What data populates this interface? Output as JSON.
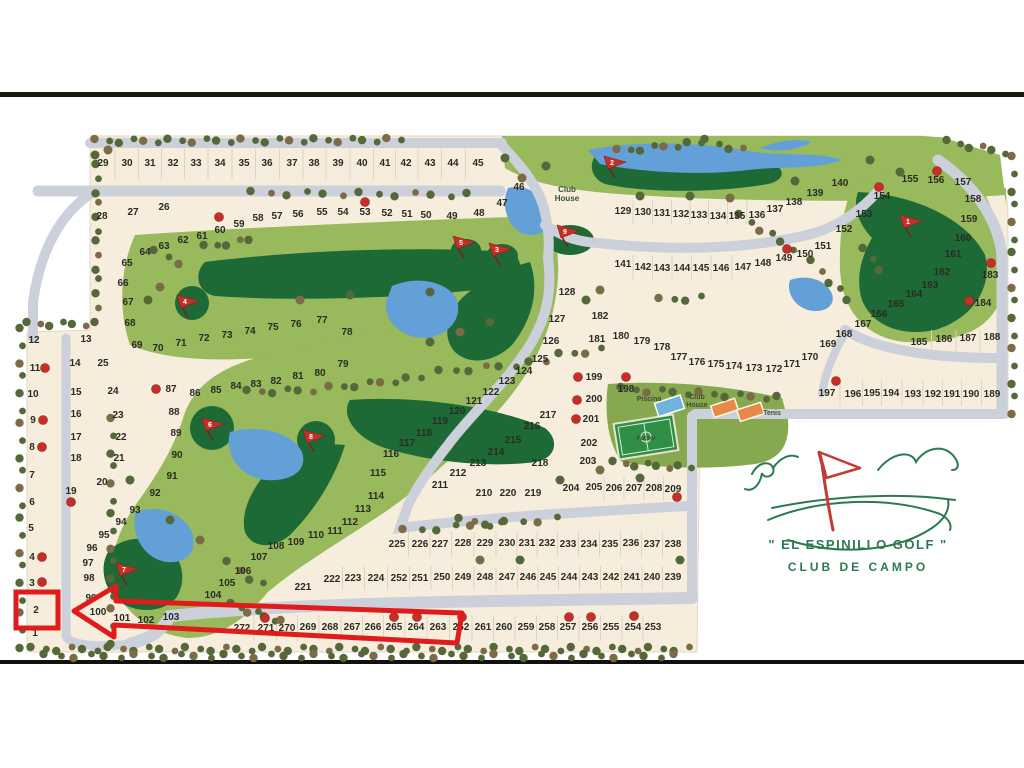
{
  "map": {
    "title": "El Espinillo Golf - Club de Campo - master plan",
    "logo": {
      "line1": "\" EL ESPINILLO GOLF \"",
      "line2": "CLUB DE CAMPO"
    },
    "labels": [
      {
        "id": "club-house-top",
        "lines": [
          "Club",
          "House"
        ],
        "x": 567,
        "y": 192,
        "size": 8
      },
      {
        "id": "piscina",
        "lines": [
          "Piscina"
        ],
        "x": 649,
        "y": 401,
        "size": 7
      },
      {
        "id": "club-house-amenity",
        "lines": [
          "Club",
          "House"
        ],
        "x": 697,
        "y": 399,
        "size": 7
      },
      {
        "id": "tenis",
        "lines": [
          "Tenis"
        ],
        "x": 772,
        "y": 415,
        "size": 7
      },
      {
        "id": "futbol",
        "lines": [
          "Futbol"
        ],
        "x": 646,
        "y": 440,
        "size": 6
      }
    ],
    "hole_flags": [
      [
        1,
        911,
        222
      ],
      [
        2,
        615,
        163
      ],
      [
        3,
        500,
        250
      ],
      [
        4,
        188,
        302
      ],
      [
        5,
        464,
        243
      ],
      [
        6,
        213,
        425
      ],
      [
        7,
        127,
        570
      ],
      [
        8,
        314,
        437
      ],
      [
        9,
        568,
        232
      ]
    ],
    "red_dots": [
      [
        219,
        217
      ],
      [
        365,
        202
      ],
      [
        156,
        389
      ],
      [
        71,
        502
      ],
      [
        45,
        368
      ],
      [
        43,
        420
      ],
      [
        42,
        447
      ],
      [
        42,
        557
      ],
      [
        42,
        582
      ],
      [
        787,
        249
      ],
      [
        879,
        187
      ],
      [
        937,
        171
      ],
      [
        991,
        263
      ],
      [
        969,
        301
      ],
      [
        836,
        381
      ],
      [
        578,
        377
      ],
      [
        577,
        400
      ],
      [
        576,
        419
      ],
      [
        626,
        377
      ],
      [
        677,
        497
      ],
      [
        265,
        618
      ],
      [
        394,
        617
      ],
      [
        417,
        617
      ],
      [
        462,
        617
      ],
      [
        569,
        617
      ],
      [
        591,
        617
      ],
      [
        634,
        616
      ]
    ],
    "annotation": {
      "highlighted_lot": "2",
      "rect": [
        16,
        592,
        42,
        36
      ],
      "arrow_points": "74,611 116,586 116,601 462,613 457,643 114,625 114,637"
    },
    "colors": {
      "cream": "#f6eddc",
      "road": "#ccd0da",
      "light_green": "#98b95c",
      "dark_green": "#1d6a37",
      "water": "#64a0d8",
      "tree_olive": "#55683a",
      "tree_brown": "#7b6b46",
      "marker_red": "#c62f28",
      "annotation_red": "#e01b1b",
      "logo_green": "#2c7a50",
      "logo_red": "#c23b35",
      "number_ink": "#2b2b24"
    },
    "lots": [
      [
        1,
        35,
        633
      ],
      [
        2,
        36,
        610
      ],
      [
        3,
        32,
        583
      ],
      [
        4,
        32,
        557
      ],
      [
        5,
        31,
        528
      ],
      [
        6,
        32,
        502
      ],
      [
        7,
        32,
        475
      ],
      [
        8,
        32,
        447
      ],
      [
        9,
        33,
        420
      ],
      [
        10,
        33,
        394
      ],
      [
        11,
        35,
        368
      ],
      [
        12,
        34,
        340
      ],
      [
        13,
        86,
        339
      ],
      [
        14,
        75,
        363
      ],
      [
        15,
        76,
        392
      ],
      [
        16,
        76,
        414
      ],
      [
        17,
        76,
        437
      ],
      [
        18,
        76,
        458
      ],
      [
        19,
        71,
        491
      ],
      [
        20,
        102,
        482
      ],
      [
        21,
        119,
        458
      ],
      [
        22,
        121,
        437
      ],
      [
        23,
        118,
        415
      ],
      [
        24,
        113,
        391
      ],
      [
        25,
        103,
        363
      ],
      [
        26,
        164,
        207
      ],
      [
        27,
        133,
        212
      ],
      [
        28,
        102,
        216
      ],
      [
        29,
        103,
        163
      ],
      [
        30,
        127,
        163
      ],
      [
        31,
        150,
        163
      ],
      [
        32,
        173,
        163
      ],
      [
        33,
        196,
        163
      ],
      [
        34,
        220,
        163
      ],
      [
        35,
        244,
        163
      ],
      [
        36,
        267,
        163
      ],
      [
        37,
        292,
        163
      ],
      [
        38,
        314,
        163
      ],
      [
        39,
        338,
        163
      ],
      [
        40,
        362,
        163
      ],
      [
        41,
        385,
        163
      ],
      [
        42,
        406,
        163
      ],
      [
        43,
        430,
        163
      ],
      [
        44,
        453,
        163
      ],
      [
        45,
        478,
        163
      ],
      [
        46,
        519,
        187
      ],
      [
        47,
        502,
        203
      ],
      [
        48,
        479,
        213
      ],
      [
        49,
        452,
        216
      ],
      [
        50,
        426,
        215
      ],
      [
        51,
        407,
        214
      ],
      [
        52,
        387,
        213
      ],
      [
        53,
        365,
        212
      ],
      [
        54,
        343,
        212
      ],
      [
        55,
        322,
        212
      ],
      [
        56,
        298,
        214
      ],
      [
        57,
        277,
        216
      ],
      [
        58,
        258,
        218
      ],
      [
        59,
        239,
        224
      ],
      [
        60,
        220,
        230
      ],
      [
        61,
        202,
        236
      ],
      [
        62,
        183,
        240
      ],
      [
        63,
        164,
        246
      ],
      [
        64,
        145,
        252
      ],
      [
        65,
        127,
        263
      ],
      [
        66,
        123,
        283
      ],
      [
        67,
        128,
        302
      ],
      [
        68,
        130,
        323
      ],
      [
        69,
        137,
        345
      ],
      [
        70,
        158,
        348
      ],
      [
        71,
        181,
        343
      ],
      [
        72,
        204,
        338
      ],
      [
        73,
        227,
        335
      ],
      [
        74,
        250,
        331
      ],
      [
        75,
        273,
        327
      ],
      [
        76,
        296,
        324
      ],
      [
        77,
        322,
        320
      ],
      [
        78,
        347,
        332
      ],
      [
        79,
        343,
        364
      ],
      [
        80,
        320,
        373
      ],
      [
        81,
        298,
        376
      ],
      [
        82,
        276,
        381
      ],
      [
        83,
        256,
        384
      ],
      [
        84,
        236,
        386
      ],
      [
        85,
        216,
        390
      ],
      [
        86,
        195,
        393
      ],
      [
        87,
        171,
        389
      ],
      [
        88,
        174,
        412
      ],
      [
        89,
        176,
        433
      ],
      [
        90,
        177,
        455
      ],
      [
        91,
        172,
        476
      ],
      [
        92,
        155,
        493
      ],
      [
        93,
        135,
        510
      ],
      [
        94,
        121,
        522
      ],
      [
        95,
        104,
        535
      ],
      [
        96,
        92,
        548
      ],
      [
        97,
        88,
        563
      ],
      [
        98,
        89,
        578
      ],
      [
        99,
        91,
        598
      ],
      [
        100,
        98,
        612
      ],
      [
        101,
        122,
        618
      ],
      [
        102,
        146,
        620
      ],
      [
        103,
        171,
        617
      ],
      [
        104,
        213,
        595
      ],
      [
        105,
        227,
        583
      ],
      [
        106,
        243,
        571
      ],
      [
        107,
        259,
        557
      ],
      [
        108,
        276,
        546
      ],
      [
        109,
        296,
        542
      ],
      [
        110,
        316,
        535
      ],
      [
        111,
        335,
        531
      ],
      [
        112,
        350,
        522
      ],
      [
        113,
        363,
        509
      ],
      [
        114,
        376,
        496
      ],
      [
        115,
        378,
        473
      ],
      [
        116,
        391,
        454
      ],
      [
        117,
        407,
        443
      ],
      [
        118,
        424,
        433
      ],
      [
        119,
        440,
        421
      ],
      [
        120,
        457,
        411
      ],
      [
        121,
        474,
        401
      ],
      [
        122,
        491,
        392
      ],
      [
        123,
        507,
        381
      ],
      [
        124,
        524,
        371
      ],
      [
        125,
        540,
        359
      ],
      [
        126,
        551,
        341
      ],
      [
        127,
        557,
        319
      ],
      [
        128,
        567,
        292
      ],
      [
        129,
        623,
        211
      ],
      [
        130,
        643,
        212
      ],
      [
        131,
        662,
        213
      ],
      [
        132,
        681,
        214
      ],
      [
        133,
        699,
        215
      ],
      [
        134,
        718,
        216
      ],
      [
        135,
        737,
        216
      ],
      [
        136,
        757,
        215
      ],
      [
        137,
        775,
        209
      ],
      [
        138,
        794,
        202
      ],
      [
        139,
        815,
        193
      ],
      [
        140,
        840,
        183
      ],
      [
        141,
        623,
        264
      ],
      [
        142,
        643,
        267
      ],
      [
        143,
        662,
        268
      ],
      [
        144,
        682,
        268
      ],
      [
        145,
        701,
        268
      ],
      [
        146,
        721,
        268
      ],
      [
        147,
        743,
        267
      ],
      [
        148,
        763,
        263
      ],
      [
        149,
        784,
        258
      ],
      [
        150,
        805,
        254
      ],
      [
        151,
        823,
        246
      ],
      [
        152,
        844,
        229
      ],
      [
        153,
        864,
        214
      ],
      [
        154,
        882,
        196
      ],
      [
        155,
        910,
        179
      ],
      [
        156,
        936,
        180
      ],
      [
        157,
        963,
        182
      ],
      [
        158,
        973,
        199
      ],
      [
        159,
        969,
        219
      ],
      [
        160,
        963,
        238
      ],
      [
        161,
        953,
        254
      ],
      [
        162,
        942,
        272
      ],
      [
        163,
        930,
        285
      ],
      [
        164,
        914,
        294
      ],
      [
        165,
        896,
        304
      ],
      [
        166,
        879,
        314
      ],
      [
        167,
        863,
        324
      ],
      [
        168,
        844,
        334
      ],
      [
        169,
        828,
        344
      ],
      [
        170,
        810,
        357
      ],
      [
        171,
        792,
        364
      ],
      [
        172,
        774,
        369
      ],
      [
        173,
        754,
        368
      ],
      [
        174,
        734,
        366
      ],
      [
        175,
        716,
        364
      ],
      [
        176,
        697,
        362
      ],
      [
        177,
        679,
        357
      ],
      [
        178,
        662,
        347
      ],
      [
        179,
        642,
        341
      ],
      [
        180,
        621,
        336
      ],
      [
        181,
        597,
        339
      ],
      [
        182,
        600,
        316
      ],
      [
        183,
        990,
        275
      ],
      [
        184,
        983,
        303
      ],
      [
        185,
        919,
        342
      ],
      [
        186,
        944,
        339
      ],
      [
        187,
        968,
        338
      ],
      [
        188,
        992,
        337
      ],
      [
        189,
        992,
        394
      ],
      [
        190,
        971,
        394
      ],
      [
        191,
        952,
        394
      ],
      [
        192,
        933,
        394
      ],
      [
        193,
        913,
        394
      ],
      [
        194,
        891,
        393
      ],
      [
        195,
        872,
        393
      ],
      [
        196,
        853,
        394
      ],
      [
        197,
        827,
        393
      ],
      [
        198,
        626,
        389
      ],
      [
        199,
        594,
        377
      ],
      [
        200,
        594,
        399
      ],
      [
        201,
        591,
        419
      ],
      [
        202,
        589,
        443
      ],
      [
        203,
        588,
        461
      ],
      [
        204,
        571,
        488
      ],
      [
        205,
        594,
        487
      ],
      [
        206,
        614,
        488
      ],
      [
        207,
        634,
        488
      ],
      [
        208,
        654,
        488
      ],
      [
        209,
        673,
        489
      ],
      [
        210,
        484,
        493
      ],
      [
        211,
        440,
        485
      ],
      [
        212,
        458,
        473
      ],
      [
        213,
        478,
        463
      ],
      [
        214,
        496,
        452
      ],
      [
        215,
        513,
        440
      ],
      [
        216,
        532,
        426
      ],
      [
        217,
        548,
        415
      ],
      [
        218,
        540,
        463
      ],
      [
        219,
        533,
        493
      ],
      [
        220,
        508,
        493
      ],
      [
        221,
        303,
        587
      ],
      [
        222,
        332,
        579
      ],
      [
        223,
        353,
        578
      ],
      [
        224,
        376,
        578
      ],
      [
        225,
        397,
        544
      ],
      [
        226,
        420,
        544
      ],
      [
        227,
        440,
        544
      ],
      [
        228,
        463,
        543
      ],
      [
        229,
        485,
        543
      ],
      [
        230,
        507,
        543
      ],
      [
        231,
        527,
        543
      ],
      [
        232,
        547,
        543
      ],
      [
        233,
        568,
        544
      ],
      [
        234,
        589,
        544
      ],
      [
        235,
        610,
        544
      ],
      [
        236,
        631,
        543
      ],
      [
        237,
        652,
        544
      ],
      [
        238,
        673,
        544
      ],
      [
        239,
        673,
        577
      ],
      [
        240,
        652,
        577
      ],
      [
        241,
        632,
        577
      ],
      [
        242,
        611,
        577
      ],
      [
        243,
        590,
        577
      ],
      [
        244,
        569,
        577
      ],
      [
        245,
        548,
        577
      ],
      [
        246,
        528,
        577
      ],
      [
        247,
        507,
        577
      ],
      [
        248,
        485,
        577
      ],
      [
        249,
        463,
        577
      ],
      [
        250,
        442,
        577
      ],
      [
        251,
        420,
        578
      ],
      [
        252,
        399,
        578
      ],
      [
        253,
        653,
        627
      ],
      [
        254,
        633,
        627
      ],
      [
        255,
        611,
        627
      ],
      [
        256,
        590,
        627
      ],
      [
        257,
        568,
        627
      ],
      [
        258,
        547,
        627
      ],
      [
        259,
        526,
        627
      ],
      [
        260,
        504,
        627
      ],
      [
        261,
        483,
        627
      ],
      [
        262,
        461,
        627
      ],
      [
        263,
        438,
        627
      ],
      [
        264,
        416,
        627
      ],
      [
        265,
        394,
        627
      ],
      [
        266,
        373,
        627
      ],
      [
        267,
        352,
        627
      ],
      [
        268,
        330,
        627
      ],
      [
        269,
        308,
        627
      ],
      [
        270,
        287,
        628
      ],
      [
        271,
        266,
        628
      ],
      [
        272,
        242,
        628
      ]
    ]
  }
}
